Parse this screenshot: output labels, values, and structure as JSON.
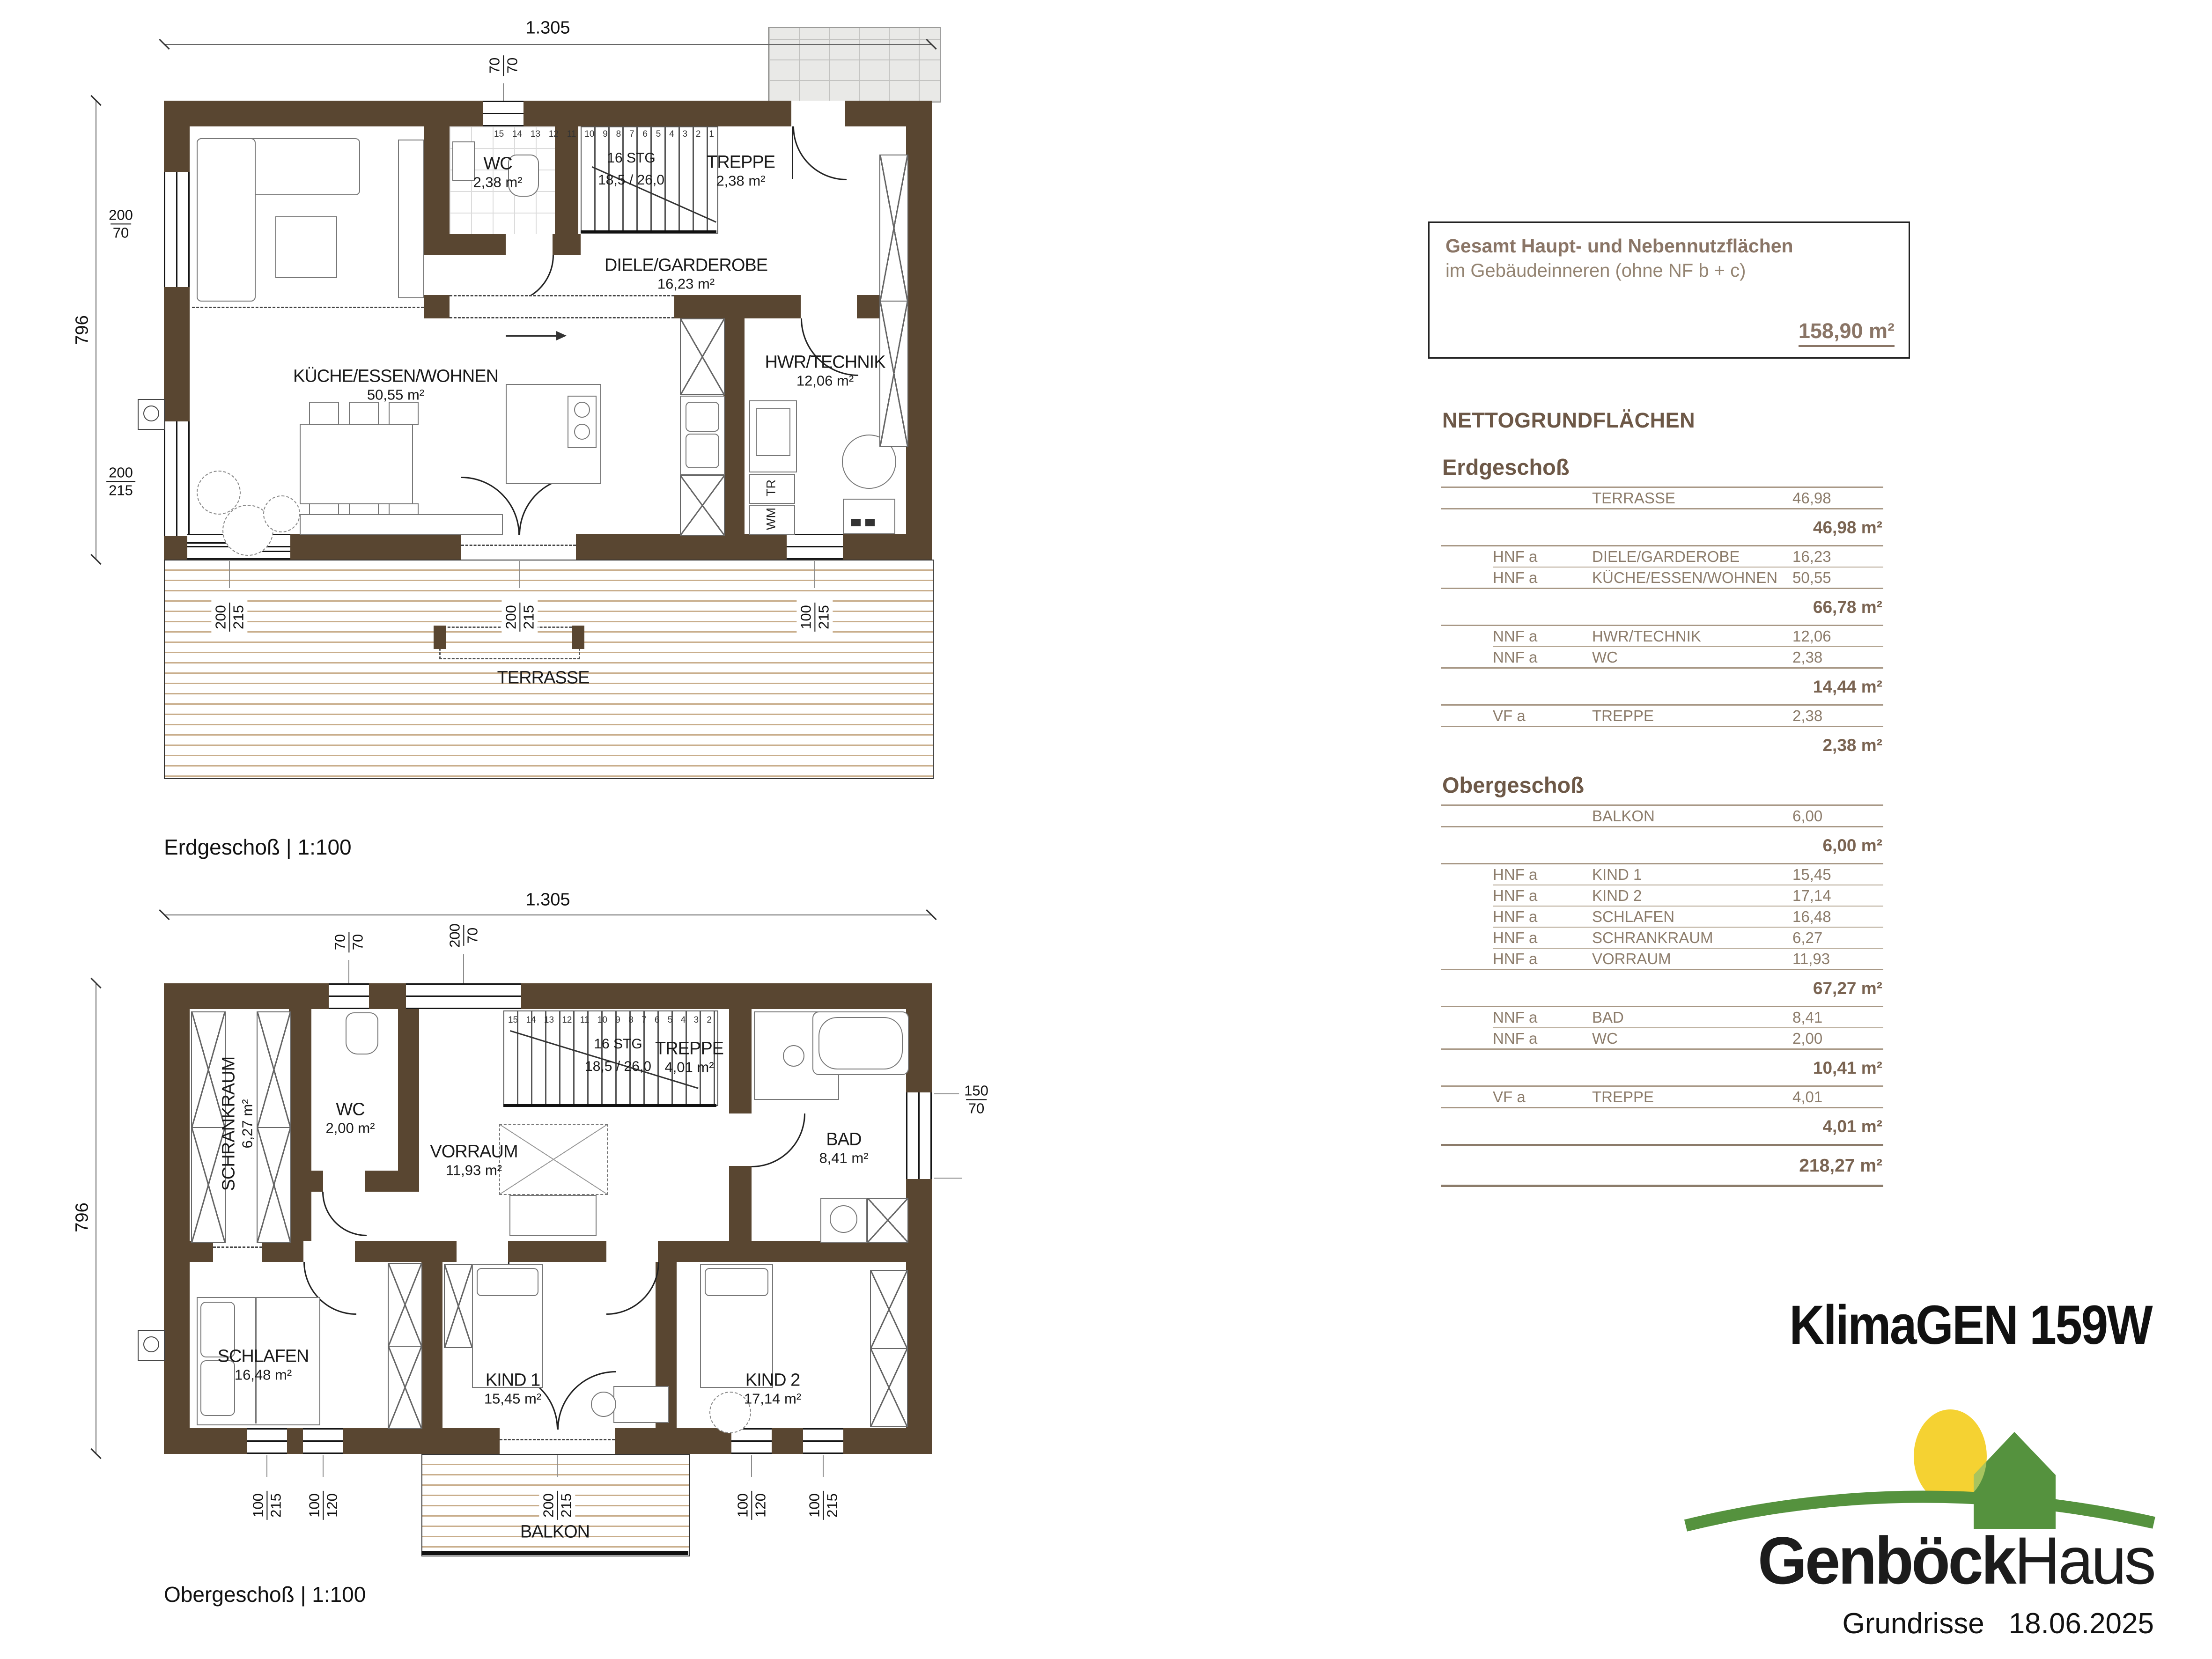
{
  "branding": {
    "model": "KlimaGEN 159W",
    "brand_bold": "Genböck",
    "brand_light": "Haus",
    "doc_type": "Grundrisse",
    "date": "18.06.2025"
  },
  "summary_box": {
    "title": "Gesamt Haupt- und Nebennutzflächen",
    "subtitle": "im Gebäudeinneren (ohne NF b + c)",
    "total": "158,90 m²"
  },
  "areas": {
    "title": "NETTOGRUNDFLÄCHEN",
    "sections": [
      {
        "name": "Erdgeschoß",
        "groups": [
          {
            "rows": [
              {
                "cat": "",
                "room": "TERRASSE",
                "value": "46,98"
              }
            ],
            "subtotal": "46,98 m²"
          },
          {
            "rows": [
              {
                "cat": "HNF a",
                "room": "DIELE/GARDEROBE",
                "value": "16,23"
              },
              {
                "cat": "HNF a",
                "room": "KÜCHE/ESSEN/WOHNEN",
                "value": "50,55"
              }
            ],
            "subtotal": "66,78 m²"
          },
          {
            "rows": [
              {
                "cat": "NNF a",
                "room": "HWR/TECHNIK",
                "value": "12,06"
              },
              {
                "cat": "NNF a",
                "room": "WC",
                "value": "2,38"
              }
            ],
            "subtotal": "14,44 m²"
          },
          {
            "rows": [
              {
                "cat": "VF a",
                "room": "TREPPE",
                "value": "2,38"
              }
            ],
            "subtotal": "2,38 m²"
          }
        ]
      },
      {
        "name": "Obergeschoß",
        "groups": [
          {
            "rows": [
              {
                "cat": "",
                "room": "BALKON",
                "value": "6,00"
              }
            ],
            "subtotal": "6,00 m²"
          },
          {
            "rows": [
              {
                "cat": "HNF a",
                "room": "KIND 1",
                "value": "15,45"
              },
              {
                "cat": "HNF a",
                "room": "KIND 2",
                "value": "17,14"
              },
              {
                "cat": "HNF a",
                "room": "SCHLAFEN",
                "value": "16,48"
              },
              {
                "cat": "HNF a",
                "room": "SCHRANKRAUM",
                "value": "6,27"
              },
              {
                "cat": "HNF a",
                "room": "VORRAUM",
                "value": "11,93"
              }
            ],
            "subtotal": "67,27 m²"
          },
          {
            "rows": [
              {
                "cat": "NNF a",
                "room": "BAD",
                "value": "8,41"
              },
              {
                "cat": "NNF a",
                "room": "WC",
                "value": "2,00"
              }
            ],
            "subtotal": "10,41 m²"
          },
          {
            "rows": [
              {
                "cat": "VF a",
                "room": "TREPPE",
                "value": "4,01"
              }
            ],
            "subtotal": "4,01 m²"
          }
        ]
      }
    ],
    "grand_total": "218,27 m²"
  },
  "plan": {
    "eg": {
      "caption": "Erdgeschoß | 1:100",
      "rooms": {
        "wc": {
          "name": "WC",
          "area": "2,38 m²"
        },
        "treppe": {
          "name": "TREPPE",
          "area": "2,38 m²",
          "stg": "16 STG",
          "steigung": "18,5 / 26,0",
          "steps": "15 14 13 12 11 10 9 8 7 6 5 4 3 2 1"
        },
        "diele": {
          "name": "DIELE/GARDEROBE",
          "area": "16,23 m²"
        },
        "kueche": {
          "name": "KÜCHE/ESSEN/WOHNEN",
          "area": "50,55 m²"
        },
        "hwr": {
          "name": "HWR/TECHNIK",
          "area": "12,06 m²"
        },
        "terrasse": {
          "name": "TERRASSE"
        }
      },
      "appliances": {
        "tr": "TR",
        "wm": "WM"
      },
      "dims": {
        "width": "1.305",
        "height": "796",
        "top_win": {
          "a": "70",
          "b": "70"
        },
        "left_win1": {
          "a": "200",
          "b": "70"
        },
        "left_win2": {
          "a": "200",
          "b": "215"
        },
        "bottom1": {
          "a": "200",
          "b": "215"
        },
        "bottom2": {
          "a": "200",
          "b": "215"
        },
        "bottom3": {
          "a": "100",
          "b": "215"
        }
      }
    },
    "og": {
      "caption": "Obergeschoß | 1:100",
      "rooms": {
        "schrankraum": {
          "name": "SCHRANKRAUM",
          "area": "6,27 m²"
        },
        "wc": {
          "name": "WC",
          "area": "2,00 m²"
        },
        "vorraum": {
          "name": "VORRAUM",
          "area": "11,93 m²"
        },
        "treppe": {
          "name": "TREPPE",
          "area": "4,01 m²",
          "stg": "16 STG",
          "steigung": "18,5 / 26,0",
          "steps": "15 14 13 12 11 10 9 8 7 6 5 4 3 2"
        },
        "bad": {
          "name": "BAD",
          "area": "8,41 m²"
        },
        "schlafen": {
          "name": "SCHLAFEN",
          "area": "16,48 m²"
        },
        "kind1": {
          "name": "KIND 1",
          "area": "15,45 m²"
        },
        "kind2": {
          "name": "KIND 2",
          "area": "17,14 m²"
        },
        "balkon": {
          "name": "BALKON"
        }
      },
      "dims": {
        "width": "1.305",
        "height": "796",
        "top_win1": {
          "a": "70",
          "b": "70"
        },
        "top_win2": {
          "a": "200",
          "b": "70"
        },
        "right_win": {
          "a": "150",
          "b": "70"
        },
        "bottom1": {
          "a": "100",
          "b": "215"
        },
        "bottom2": {
          "a": "100",
          "b": "120"
        },
        "bottom3": {
          "a": "200",
          "b": "215"
        },
        "bottom4": {
          "a": "100",
          "b": "120"
        },
        "bottom5": {
          "a": "100",
          "b": "215"
        }
      }
    }
  },
  "colors": {
    "wall": "#594631",
    "deck_line": "#c9ae8c",
    "paving": "#e9e9e7",
    "table_text": "#8c7c6b",
    "table_heading": "#6d5847",
    "logo_green": "#55923e",
    "logo_light_green": "#a8c45e",
    "logo_yellow": "#f5d232"
  }
}
